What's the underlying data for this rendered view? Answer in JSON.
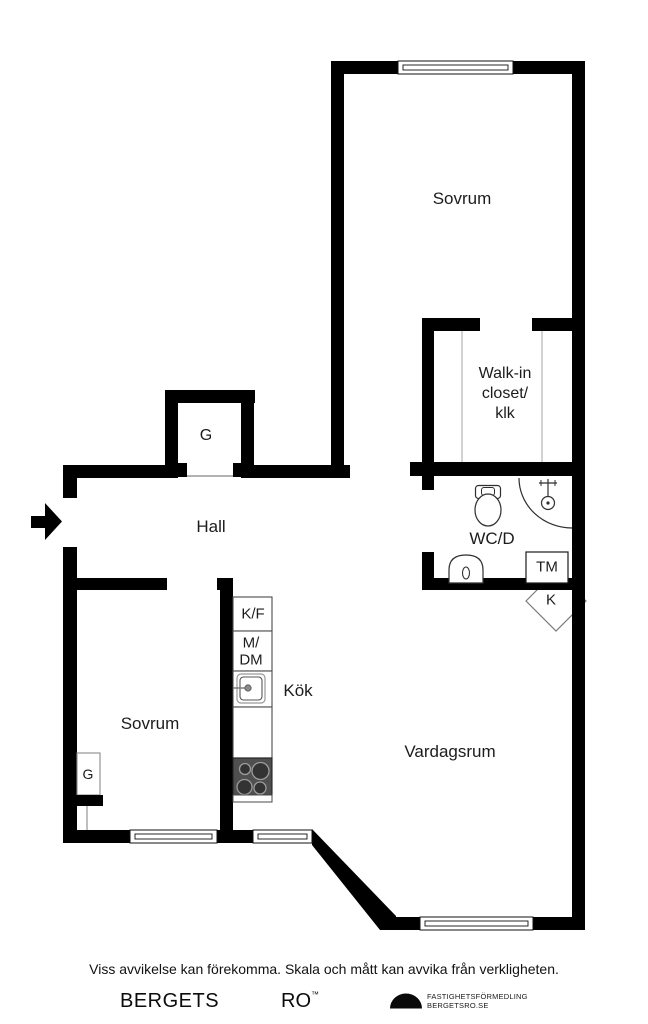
{
  "colors": {
    "wall": "#000000",
    "background": "#ffffff",
    "stove_fill": "#4f4f4f",
    "burner_fill": "#333333",
    "burner_stroke": "#9c9c9c",
    "fixture_stroke": "#2f2f2f",
    "light_line": "#b3b3b3"
  },
  "rooms": {
    "bedroom_top": "Sovrum",
    "walk_in_closet_line1": "Walk-in",
    "walk_in_closet_line2": "closet/",
    "walk_in_closet_line3": "klk",
    "hall": "Hall",
    "wc": "WC/D",
    "bedroom_bottom": "Sovrum",
    "kitchen": "Kök",
    "living_room": "Vardagsrum"
  },
  "fixtures": {
    "wardrobe_hall": "G",
    "wardrobe_bedroom": "G",
    "washing_machine": "TM",
    "cabinet": "K",
    "fridge_freezer": "K/F",
    "microwave_dishwasher_line1": "M/",
    "microwave_dishwasher_line2": "DM"
  },
  "footer": {
    "disclaimer": "Viss avvikelse kan förekomma. Skala och mått kan avvika från verkligheten.",
    "brand_word1": "BERGETS",
    "brand_word2": "RO",
    "trademark": "™",
    "agency_line1": "FASTIGHETSFÖRMEDLING",
    "agency_line2": "BERGETSRO.SE"
  }
}
